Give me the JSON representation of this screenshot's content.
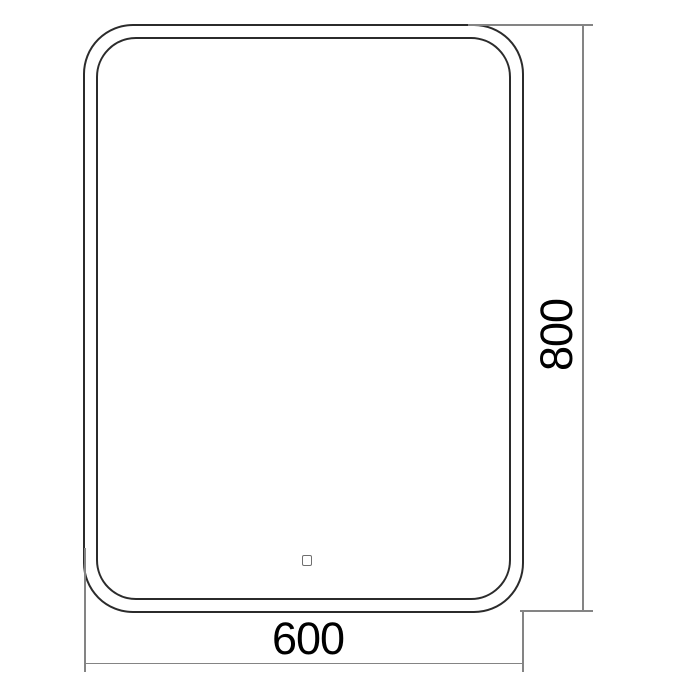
{
  "drawing": {
    "dimensions": {
      "width_label": "600",
      "height_label": "800"
    },
    "icons": {
      "touch_sensor": "touch-sensor-icon"
    },
    "colors": {
      "outline": "#2b2b2b",
      "dimension_line": "#848484",
      "label_text": "#000000",
      "background": "#ffffff"
    }
  }
}
